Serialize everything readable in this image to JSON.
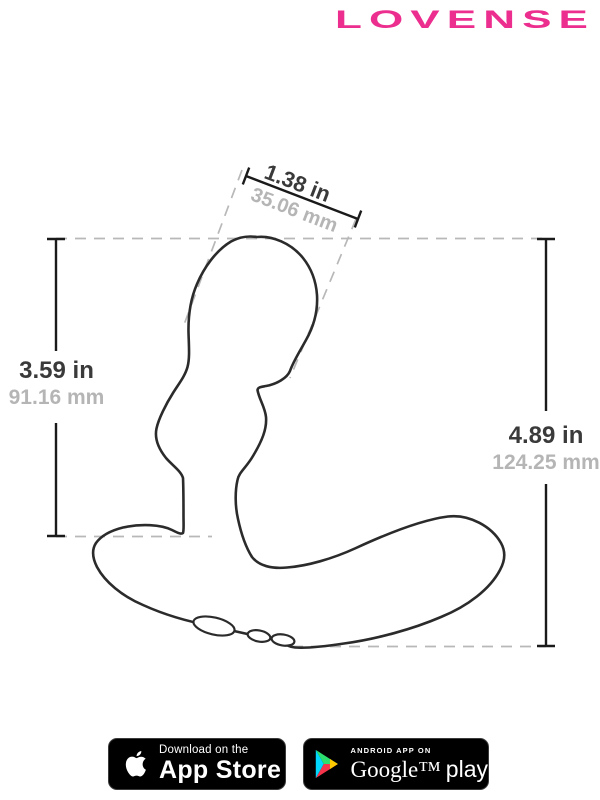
{
  "brand": {
    "logo_text": "LOVENSE",
    "logo_color": "#ec2e8e"
  },
  "diagram": {
    "outline_color": "#2b2b2b",
    "dimension_line_color": "#1a1a1a",
    "extension_dash_color": "#b8b8b8",
    "measurements": {
      "head_width": {
        "in": "1.38 in",
        "mm": "35.06 mm"
      },
      "insertable_height": {
        "in": "3.59 in",
        "mm": "91.16 mm"
      },
      "total_height": {
        "in": "4.89 in",
        "mm": "124.25 mm"
      }
    }
  },
  "badges": {
    "app_store": {
      "icon": "apple-logo",
      "line1": "Download on the",
      "line2": "App Store"
    },
    "google_play": {
      "icon": "play-triangle",
      "triangle_colors": [
        "#00d7fe",
        "#2bde6e",
        "#f5344b",
        "#ffc900"
      ],
      "line1": "ANDROID APP ON",
      "wordmark_serif": "Google™",
      "wordmark_sans": "play"
    }
  }
}
